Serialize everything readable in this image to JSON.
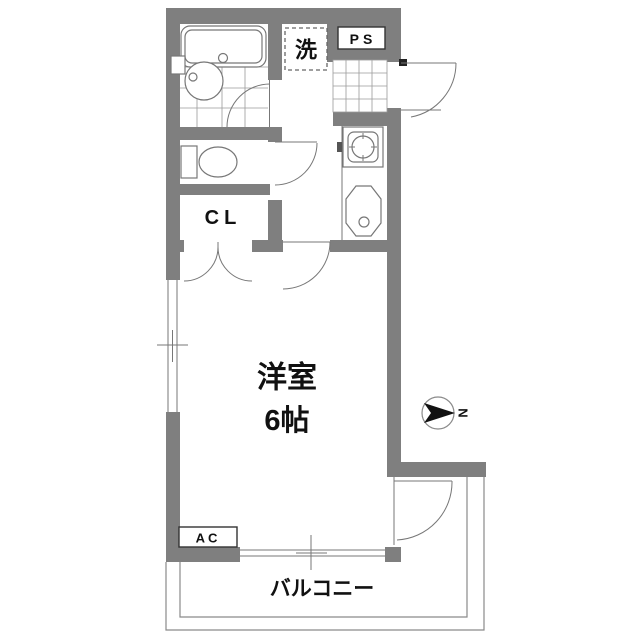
{
  "floorplan": {
    "rooms": {
      "main_room": {
        "name": "洋室",
        "size": "6帖"
      },
      "closet_label": "CL",
      "pipe_space_label": "PS",
      "washer_label": "洗",
      "ac_label": "AC",
      "balcony_label": "バルコニー"
    },
    "compass": {
      "north_label": "N"
    },
    "colors": {
      "wall": "#7f7f7f",
      "fixture_line": "#777777",
      "balcony_line": "#8a8a8a",
      "text": "#111111"
    }
  }
}
